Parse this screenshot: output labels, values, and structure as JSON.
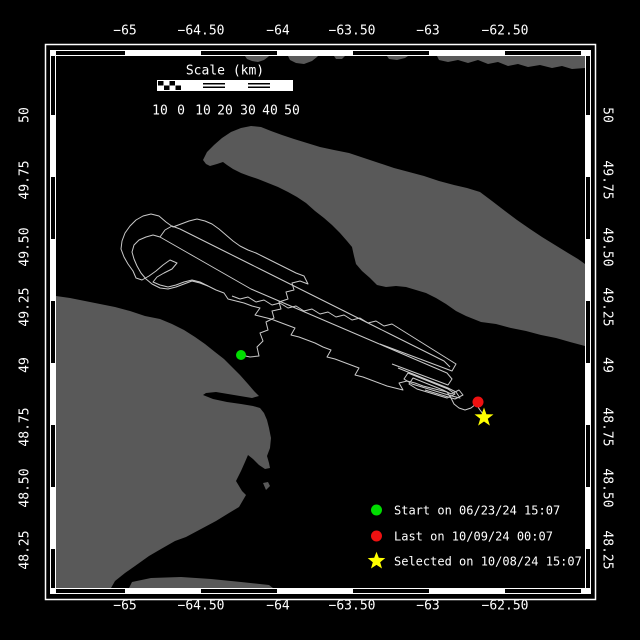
{
  "canvas": {
    "width": 640,
    "height": 640,
    "background": "#000000"
  },
  "colors": {
    "water": "#000000",
    "land": "#595959",
    "track": "#c9c9c9",
    "frame": "#ffffff",
    "text": "#ffffff",
    "start": "#00dd00",
    "last": "#ee1111",
    "selected": "#ffff00"
  },
  "axes": {
    "top": {
      "labels": [
        "−65",
        "−64.50",
        "−64",
        "−63.50",
        "−63",
        "−62.50"
      ]
    },
    "bottom": {
      "labels": [
        "−65",
        "−64.50",
        "−64",
        "−63.50",
        "−63",
        "−62.50"
      ]
    },
    "left": {
      "labels": [
        "50",
        "49.75",
        "49.50",
        "49.25",
        "49",
        "48.75",
        "48.50",
        "48.25"
      ]
    },
    "right": {
      "labels": [
        "50",
        "49.75",
        "49.50",
        "49.25",
        "49",
        "48.75",
        "48.50",
        "48.25"
      ]
    }
  },
  "scalebar": {
    "title": "Scale (km)",
    "labels": [
      "10",
      "0",
      "10",
      "20",
      "30",
      "40",
      "50"
    ]
  },
  "legend": {
    "rows": [
      {
        "marker": "circle",
        "color_key": "start",
        "label": "Start on 06/23/24 15:07"
      },
      {
        "marker": "circle",
        "color_key": "last",
        "label": "Last on 10/09/24 00:07"
      },
      {
        "marker": "star",
        "color_key": "selected",
        "label": "Selected on 10/08/24 15:07"
      }
    ]
  },
  "map": {
    "frame": {
      "plot": {
        "x0": 56,
        "y0": 56,
        "x1": 585,
        "y1": 588
      },
      "band_thickness": 6,
      "outer_rect": {
        "x": 45.5,
        "y": 44.5,
        "w": 550,
        "h": 555
      },
      "zebra": {
        "lon_anchor": 125,
        "lon_step": 76,
        "lat_anchor": 115,
        "lat_step": 62
      }
    },
    "land": [
      {
        "name": "north-shore-islet-1",
        "points": "245,56 247,59 252,61 258,62 264,60 268,57 269,56"
      },
      {
        "name": "north-shore-islet-2",
        "points": "288,56 290,60 296,63 304,64 312,61 317,57 318,56"
      },
      {
        "name": "north-shore-islet-3",
        "points": "334,56 336,59 342,59 345,56"
      },
      {
        "name": "north-shore-islet-4",
        "points": "387,56 389,59 397,60 405,58 408,56"
      },
      {
        "name": "north-shore-strip",
        "points": "437,56 439,60 448,62 458,60 468,63 478,60 488,64 498,62 508,66 518,64 528,67 540,65 552,68 562,66 572,69 585,68 585,56"
      },
      {
        "name": "anticosti-island",
        "points": "203,160 207,152 214,145 222,138 231,132 241,128 251,126 261,127 271,131 282,135 294,139 307,143 320,147 334,150 349,153 364,158 379,163 394,168 409,172 424,176 439,181 454,185 467,188 480,192 492,201 505,211 517,220 530,229 542,237 555,245 568,253 578,259 585,264 585,346 570,342 556,338 541,335 526,331 511,328 496,324 481,322 466,316 456,311 446,304 436,298 426,293 416,290 406,287 396,286 386,287 377,285 370,278 362,271 356,264 354,256 352,247 347,241 340,233 332,225 324,218 315,211 306,203 297,197 288,192 278,187 268,183 258,179 249,176 241,173 233,169 227,165 223,162 217,164 210,166 206,164"
      },
      {
        "name": "gaspe-peninsula",
        "points": "56,296 70,298 85,301 100,304 115,307 130,311 145,316 160,319 172,324 184,330 195,337 205,344 215,352 224,359 232,367 240,375 248,384 254,391 259,396 252,398 240,396 228,394 216,392 206,393 203,395 213,399 227,402 241,404 253,406 260,408 264,413 267,420 269,428 271,438 270,448 267,456 269,463 270,468 265,469 259,465 253,459 248,455 245,462 241,471 236,481 242,491 246,495 239,507 229,513 216,521 201,529 186,537 175,541 161,549 149,556 135,566 125,573 115,581 111,588 56,588"
      },
      {
        "name": "gaspe-south-sliver",
        "points": "129,588 132,582 151,578 181,577 211,579 241,582 269,585 273,588"
      },
      {
        "name": "islet-near-gaspe-tip",
        "points": "263,483 268,482 270,486 266,490"
      }
    ],
    "track": {
      "strands": [
        "241,355 250,357 259,356 257,347 263,341 260,333 268,330 266,322 274,318 272,311 281,309 279,302 288,299 286,292 294,290 292,283 300,281 308,284 304,276 296,273 288,269 280,265 272,261 264,257 256,253 248,250 240,246 233,241 226,235 219,229 212,224 205,221 197,219 189,221 181,224 173,227 166,222 159,216 151,214 143,216 136,220 130,226 125,233 122,241 121,249 124,257 128,264 133,271 136,278 142,280 149,276 156,271 163,265 170,260 177,263 172,269 164,273 157,277 153,282 160,285 168,287 176,285 184,282 192,280 200,282 208,286 216,290 224,293 228,299 236,301 244,303 252,306 260,308 255,315 263,317 271,319 279,322 287,325 295,328 291,335 299,337 307,340 315,343 323,347 331,350 327,357 335,359 343,362 351,365 359,368 355,375 363,377 371,380 379,383 387,386 395,388 403,390 399,383 407,381 415,383 423,386 431,388 439,390 447,392 451,398 454,404 459,408 465,410 471,408 476,404",
        "208,286 200,283 192,281 184,284 176,287 168,289 160,288 152,284 146,279 141,273 137,266 134,259 132,252 134,245 139,240 146,237 153,235 160,237 167,241 174,245 181,249 188,253 195,257 202,261 209,265 216,269 223,273 230,277 237,281 244,285 251,289 258,292 265,295 272,298 279,301 286,304 293,307 300,310 307,313 314,316 321,319 328,322 335,325 342,328 349,331 356,334 363,337 370,340 377,343 384,346 391,349 398,352 405,355 412,358 419,361 426,364 433,367 440,370 447,373 452,379 448,385 440,382 432,379 424,376 416,373 408,370 400,367 392,364",
        "232,296 240,299 248,297 256,302 264,300 272,305 280,303 288,308 296,306 304,311 312,309 320,314 328,312 336,317 344,315 352,320 360,318 368,323 376,321 384,326 392,324 400,329 408,334 416,339 424,344 432,349 440,354 448,359 456,364 452,371 444,368 436,365 428,362 420,359 412,356 404,353 396,350 388,347 380,344",
        "398,368 408,372 418,376 428,380 438,384 448,388 456,392 460,398 452,396 442,393 432,390 422,387 412,384 404,379 408,373 418,377 428,381 438,385 448,389 455,394 447,398 437,395 427,392 417,389 409,384 413,378 423,382 433,386 443,390 451,394 459,390 463,395 455,399 445,396 435,393 425,390",
        "160,237 165,230 172,226 180,229 188,233 196,237 204,241 212,245 220,249 228,253 236,257 244,261 252,265 260,269 268,273 276,277 284,281 292,285 300,289 308,293 316,297 324,301 332,305 340,309 348,313 356,317 364,321 372,325 380,329 388,333 396,337 404,341 412,345 420,349 428,353 436,357 444,361 450,367",
        "476,404 480,410 483,414"
      ]
    },
    "markers": {
      "start": {
        "x": 241,
        "y": 355,
        "r": 5
      },
      "last": {
        "x": 478,
        "y": 402,
        "r": 5.5
      },
      "selected": {
        "x": 484,
        "y": 417.5,
        "R": 10,
        "r": 4
      }
    }
  }
}
